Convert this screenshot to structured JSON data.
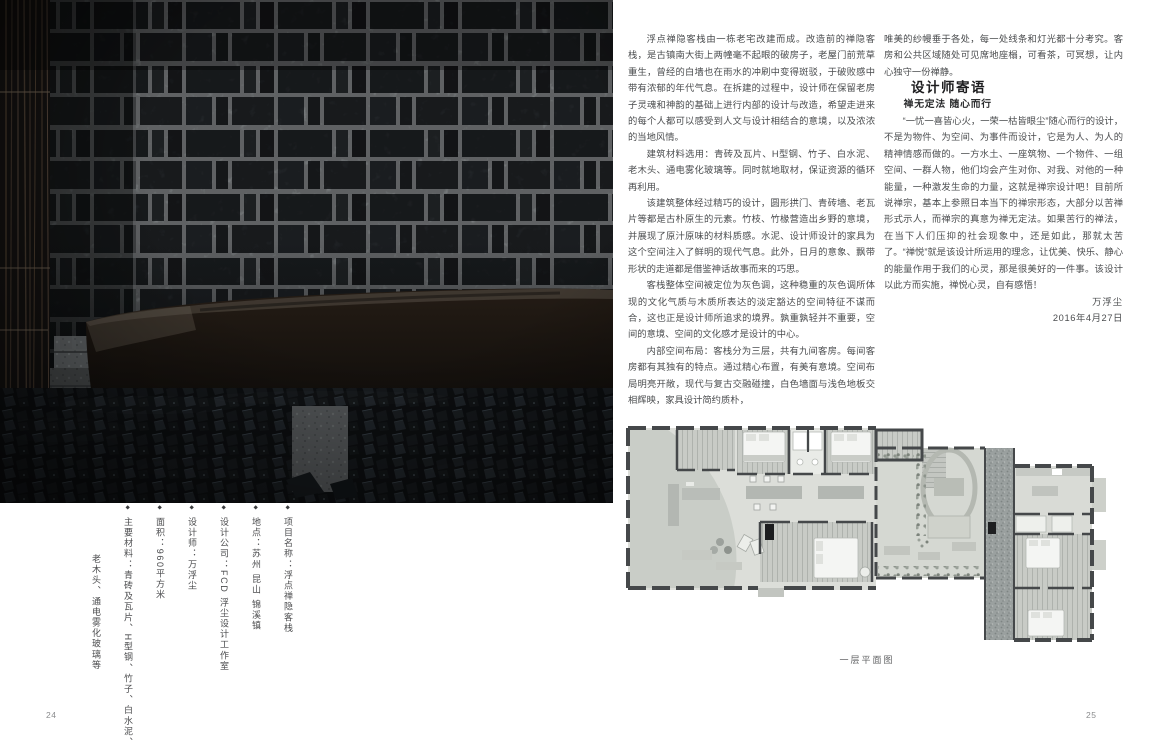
{
  "left_page": {
    "page_number": "24",
    "project_info": {
      "items": [
        "项目名称：浮点禅隐客栈",
        "地点：苏州 昆山 锦溪镇",
        "设计公司：FCD 浮尘设计工作室",
        "设计师：万浮尘",
        "面积：960平方米",
        "主要材料：青砖及瓦片、H型钢、竹子、白水泥、",
        "老木头、通电雾化玻璃等"
      ]
    }
  },
  "right_page": {
    "page_number": "25",
    "article": {
      "paragraphs": [
        "浮点禅隐客栈由一栋老宅改建而成。改造前的禅隐客栈，是古镇南大街上两幢毫不起眼的破房子，老屋门前荒草重生，曾经的白墙也在雨水的冲刷中变得斑驳，于破败感中带有浓郁的年代气息。在拆建的过程中，设计师在保留老房子灵魂和神韵的基础上进行内部的设计与改造，希望走进来的每个人都可以感受到人文与设计相结合的意境，以及浓浓的当地风情。",
        "建筑材料选用：青砖及瓦片、H型钢、竹子、白水泥、老木头、通电雾化玻璃等。同时就地取材，保证资源的循环再利用。",
        "该建筑整体经过精巧的设计，圆形拱门、青砖墙、老瓦片等都是古朴原生的元素。竹枝、竹椽营造出乡野的意境，并展现了原汁原味的材料质感。水泥、设计师设计的家具为这个空间注入了鲜明的现代气息。此外，日月的意象、飘带形状的走道都是借鉴神话故事而来的巧思。",
        "客栈整体空间被定位为灰色调，这种稳重的灰色调所体现的文化气质与木质所表达的淡定豁达的空间特征不谋而合，这也正是设计师所追求的境界。孰重孰轻并不重要，空间的意境、空间的文化感才是设计的中心。",
        "内部空间布局：客栈分为三层，共有九间客房。每间客房都有其独有的特点。通过精心布置，有美有意境。空间布局明亮开敞，现代与复古交融碰撞，白色墙面与浅色地板交相辉映，家具设计简约质朴，"
      ],
      "continuation": "唯美的纱幔垂于各处，每一处线条和灯光都十分考究。客房和公共区域随处可见席地座榻，可看茶，可冥想，让内心独守一份禅静。"
    },
    "designer_note": {
      "heading": "设计师寄语",
      "subheading": "禅无定法 随心而行",
      "body": "“一忧一喜皆心火，一荣一枯皆眼尘”随心而行的设计，不是为物件、为空间、为事件而设计，它是为人、为人的精神情感而做的。一方水土、一座筑物、一个物件、一组空间、一群人物，他们均会产生对你、对我、对他的一种能量，一种激发生命的力量，这就是禅宗设计吧！目前所说禅宗，基本上参照日本当下的禅宗形态，大部分以苦禅形式示人，而禅宗的真意为禅无定法。如果苦行的禅法，在当下人们压抑的社会现象中，还是如此，那就太苦了。“禅悦”就是该设计所运用的理念，让优美、快乐、静心的能量作用于我们的心灵，那是很美好的一件事。该设计以此方而实施，禅悦心灵，自有感悟！",
      "signature": "万浮尘",
      "date": "2016年4月27日"
    },
    "floorplan": {
      "caption": "一层平面图"
    }
  },
  "colors": {
    "page_bg": "#ffffff",
    "body_text": "#4b4d4f",
    "heading_text": "#1d1d1f",
    "photo_dark": "#17191b",
    "plan_floor": "#dcded9",
    "plan_wall": "#45484a"
  }
}
